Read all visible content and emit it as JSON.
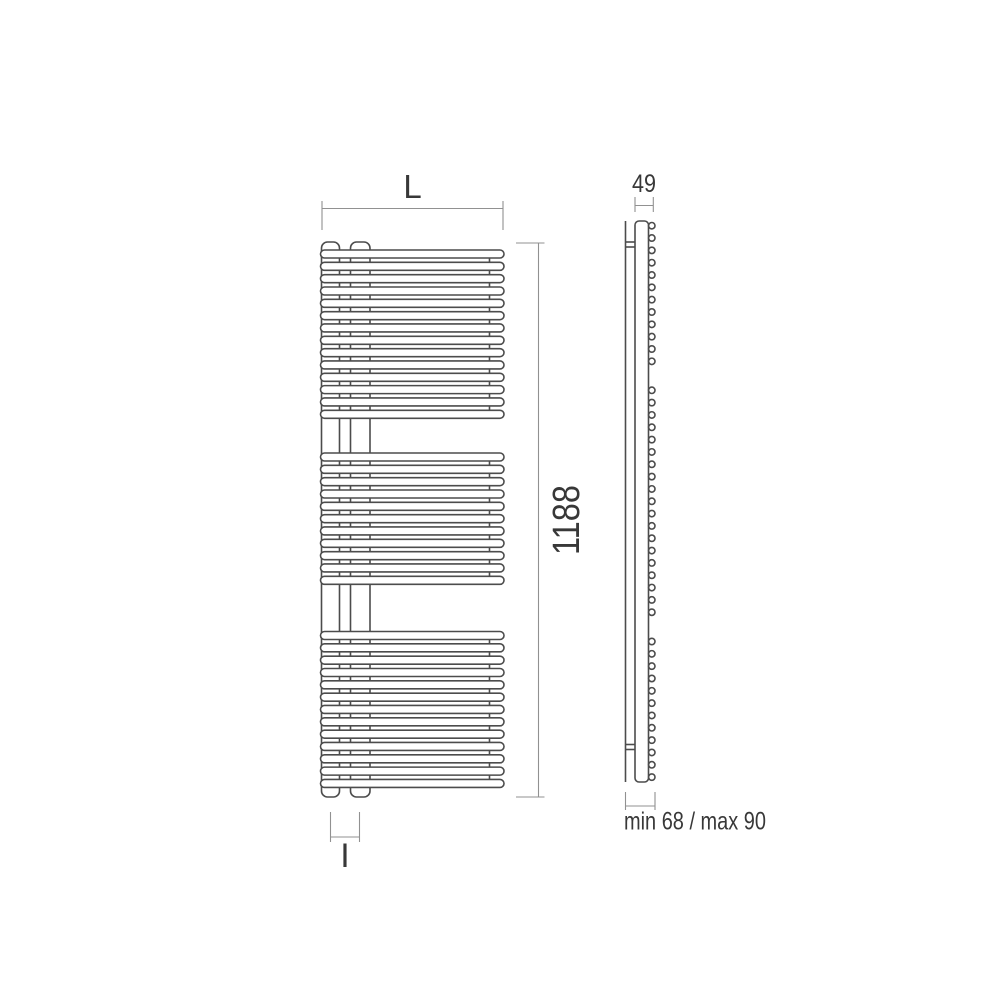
{
  "front_view": {
    "width_dim_label": "L",
    "height_dim_value": "1188",
    "connection_dim_label": "I",
    "tube_groups": [
      {
        "tubes": 14
      },
      {
        "tubes": 11
      },
      {
        "tubes": 13
      }
    ]
  },
  "side_view": {
    "depth_dim_value": "49",
    "wall_distance_value": "min 68 / max 90",
    "tube_end_circle_groups": [
      {
        "circles": 12
      },
      {
        "circles": 19
      },
      {
        "circles": 12
      }
    ]
  },
  "colors": {
    "outline": "#4c4c4c",
    "dimension_line": "#919191",
    "label_text": "#383838",
    "background": "#ffffff"
  }
}
